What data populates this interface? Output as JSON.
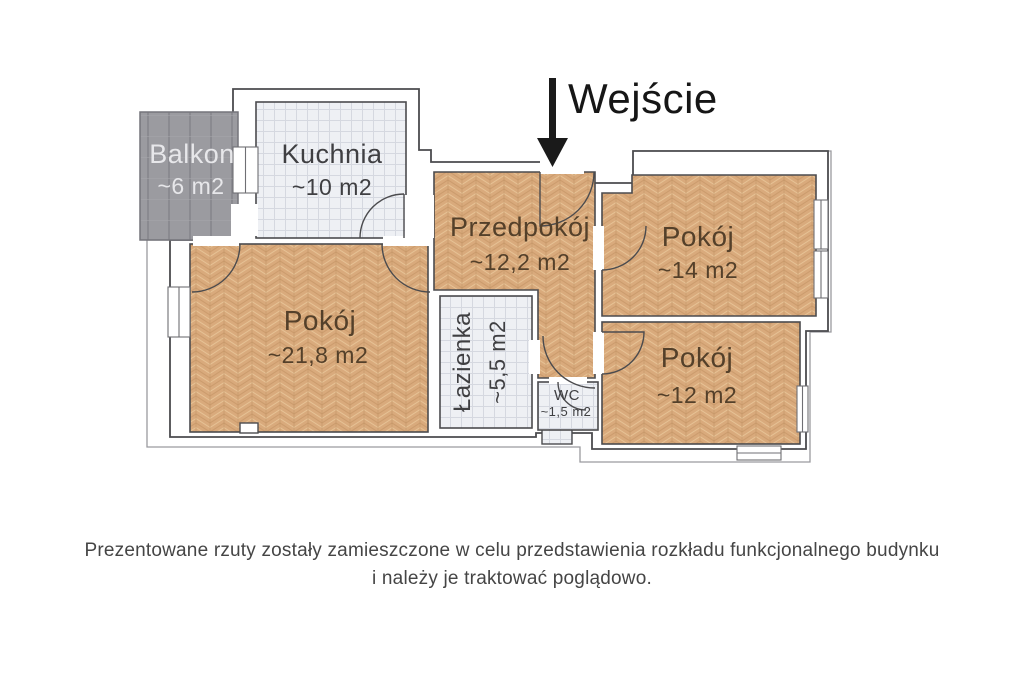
{
  "plan": {
    "entrance": {
      "label": "Wejście"
    },
    "rooms": {
      "balkon": {
        "name": "Balkon",
        "area": "~6 m2"
      },
      "kuchnia": {
        "name": "Kuchnia",
        "area": "~10 m2"
      },
      "przedpokoj": {
        "name": "Przedpokój",
        "area": "~12,2 m2"
      },
      "pokoj_14": {
        "name": "Pokój",
        "area": "~14 m2"
      },
      "pokoj_12": {
        "name": "Pokój",
        "area": "~12 m2"
      },
      "pokoj_21": {
        "name": "Pokój",
        "area": "~21,8 m2"
      },
      "lazienka": {
        "name": "Łazienka",
        "area": "~5,5 m2"
      },
      "wc": {
        "name": "WC",
        "area": "~1,5 m2"
      }
    },
    "colors": {
      "wood": "#d9aa7c",
      "wood_line": "#c09061",
      "tile": "#eef0f4",
      "tile_line": "#d5d8e0",
      "balcony": "#9b9ba0",
      "balcony_line": "#8a8a90",
      "wall_outline": "#4b4b4e",
      "contour": "#9a9a9f",
      "arrow": "#1a1a1a",
      "label_on_wood": "#54402a",
      "label_on_tile": "#3f3f42",
      "label_on_balcony": "#e7e7ea"
    }
  },
  "disclaimer": {
    "line1": "Prezentowane rzuty zostały zamieszczone w celu przedstawienia rozkładu funkcjonalnego budynku",
    "line2": "i należy je traktować poglądowo."
  }
}
